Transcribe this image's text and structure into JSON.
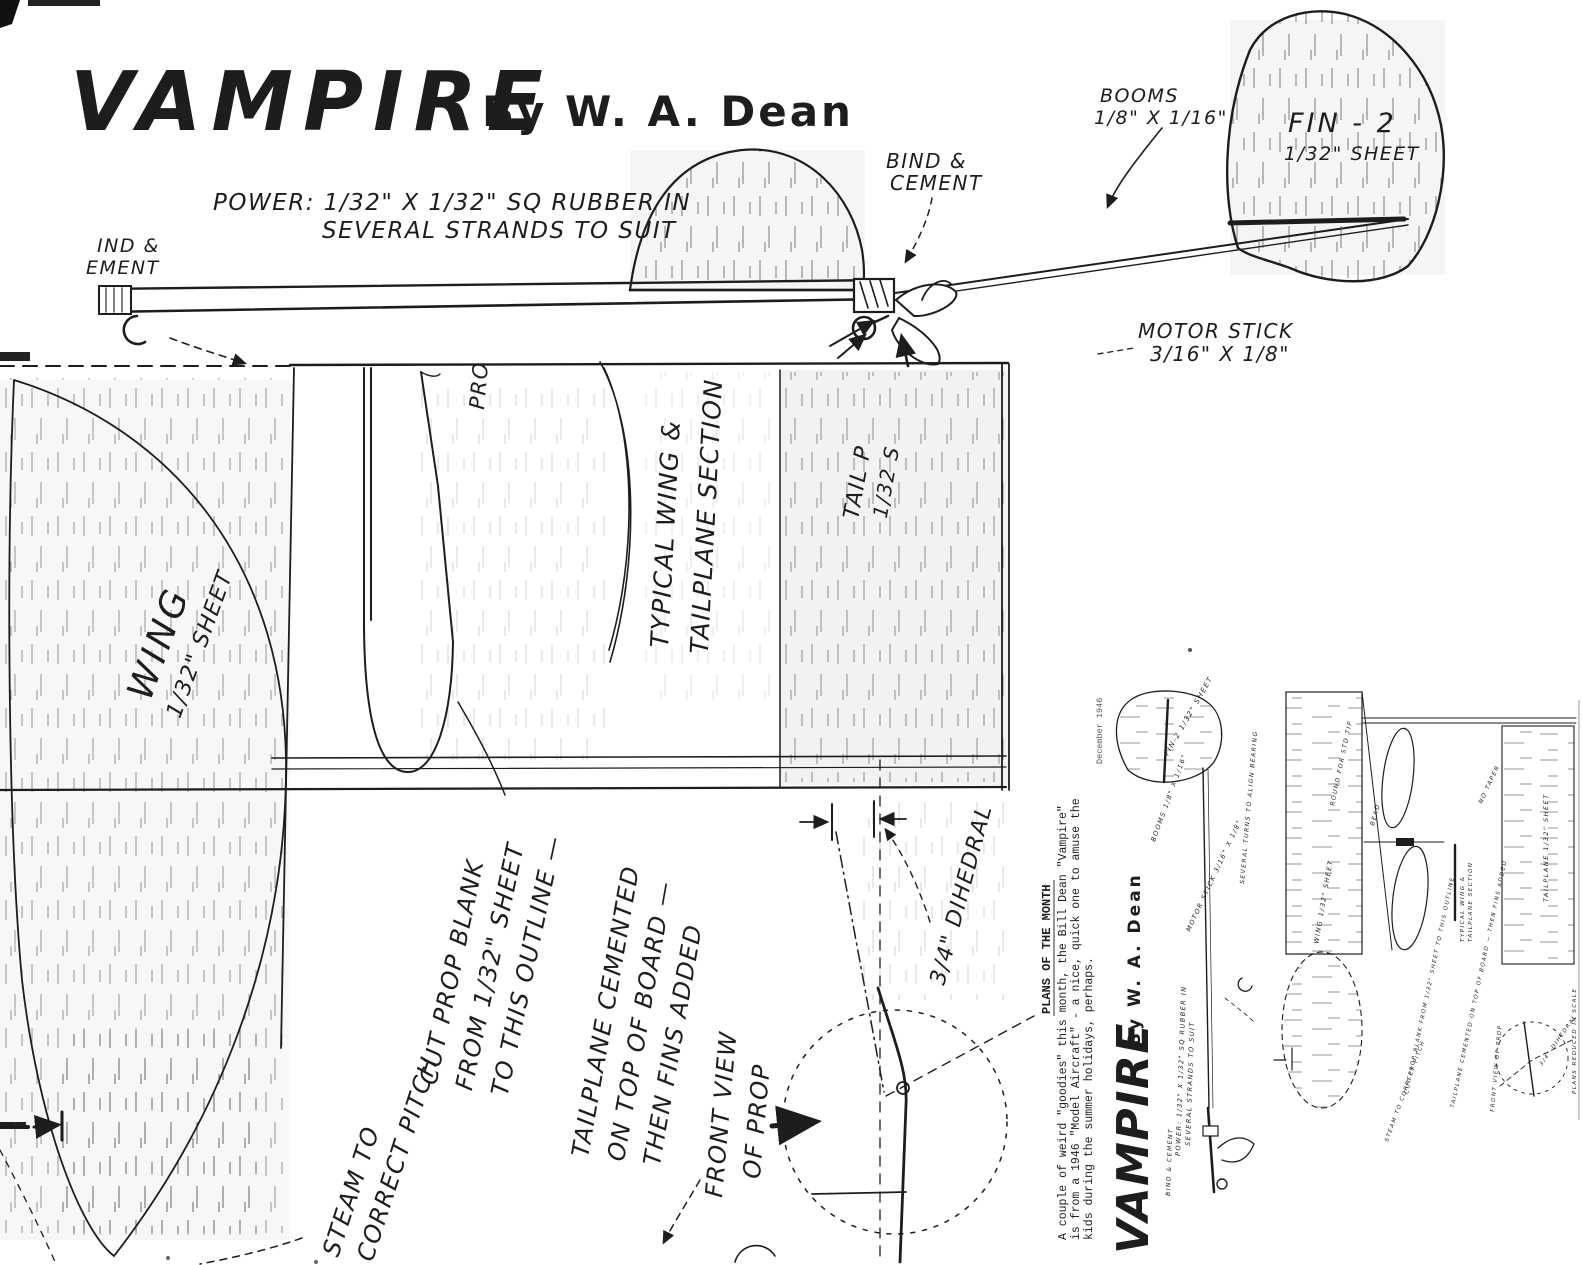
{
  "document": {
    "title": "VAMPIRE",
    "byline": "By W. A. Dean"
  },
  "side_view": {
    "power_line1": "POWER:  1/32\" X 1/32\" SQ RUBBER IN",
    "power_line2": "SEVERAL STRANDS TO SUIT",
    "bind_cement_left_line1": "IND &",
    "bind_cement_left_line2": "EMENT",
    "bind_cement_line1": "BIND &",
    "bind_cement_line2": "CEMENT",
    "booms_line1": "BOOMS",
    "booms_line2": "1/8\" X 1/16\"",
    "fin_line1": "FIN - 2",
    "fin_line2": "1/32\" SHEET",
    "motor_stick_line1": "MOTOR STICK",
    "motor_stick_line2": "3/16\" X 1/8\""
  },
  "plan_view": {
    "wing_line1": "WING",
    "wing_line2": "1/32\" SHEET",
    "prop_fragment": "PRO",
    "section_line1": "TYPICAL WING &",
    "section_line2": "TAILPLANE SECTION",
    "tail_line1": "TAIL P",
    "tail_line2": "1/32 S",
    "cut_prop_line1": "CUT PROP BLANK",
    "cut_prop_line2": "FROM 1/32\" SHEET",
    "cut_prop_line3": "TO THIS OUTLINE —",
    "tailplane_note_line1": "TAILPLANE CEMENTED",
    "tailplane_note_line2": "ON TOP OF BOARD —",
    "tailplane_note_line3": "THEN FINS ADDED",
    "steam_line1": "STEAM TO",
    "steam_line2": "CORRECT PITCH",
    "front_view_line1": "FRONT VIEW",
    "front_view_line2": "OF PROP",
    "dihedral": "3/4\" DIHEDRAL"
  },
  "inset": {
    "caption_heading": "PLANS OF THE MONTH",
    "caption_line1": "A couple of weird \"goodies\" this month, the Bill Dean \"Vampire\"",
    "caption_line2": "is from a 1946 \"Model Aircraft\" - a nice, quick one to amuse the",
    "caption_line3": "kids during the summer holidays, perhaps.",
    "page_footer": "December 1946",
    "title": "VAMPIRE",
    "byline": "By W. A. Dean",
    "mini": {
      "fin": "FIN-2 1/32\" SHEET",
      "booms": "BOOMS 1/8\" X 1/16\"",
      "motor_stick": "MOTOR STICK 3/16\" X 1/8\"",
      "turns": "SEVERAL TURNS TO ALIGN BEARING",
      "round_tip": "ROUND FOR STD TIP",
      "wing": "WING 1/32\" SHEET",
      "bead": "BEAD",
      "bind_cement": "BIND & CEMENT",
      "no_taper": "NO TAPER",
      "tailplane": "TAILPLANE 1/32\" SHEET",
      "section_line1": "TYPICAL WING &",
      "section_line2": "TAILPLANE SECTION",
      "power": "POWER: 1/32\" X 1/32\" SQ RUBBER IN",
      "power2": "SEVERAL STRANDS TO SUIT",
      "cut_prop": "CUT PROP BLANK FROM 1/32\" SHEET TO THIS OUTLINE",
      "tailplane_note": "TAILPLANE CEMENTED ON TOP OF BOARD — THEN FINS ADDED",
      "steam": "STEAM TO CORRECT PITCH",
      "front_view": "FRONT VIEW OF PROP",
      "dihedral": "3/4\" DIHEDRAL",
      "scale_note": "PLANS REDUCED IN SCALE"
    }
  }
}
